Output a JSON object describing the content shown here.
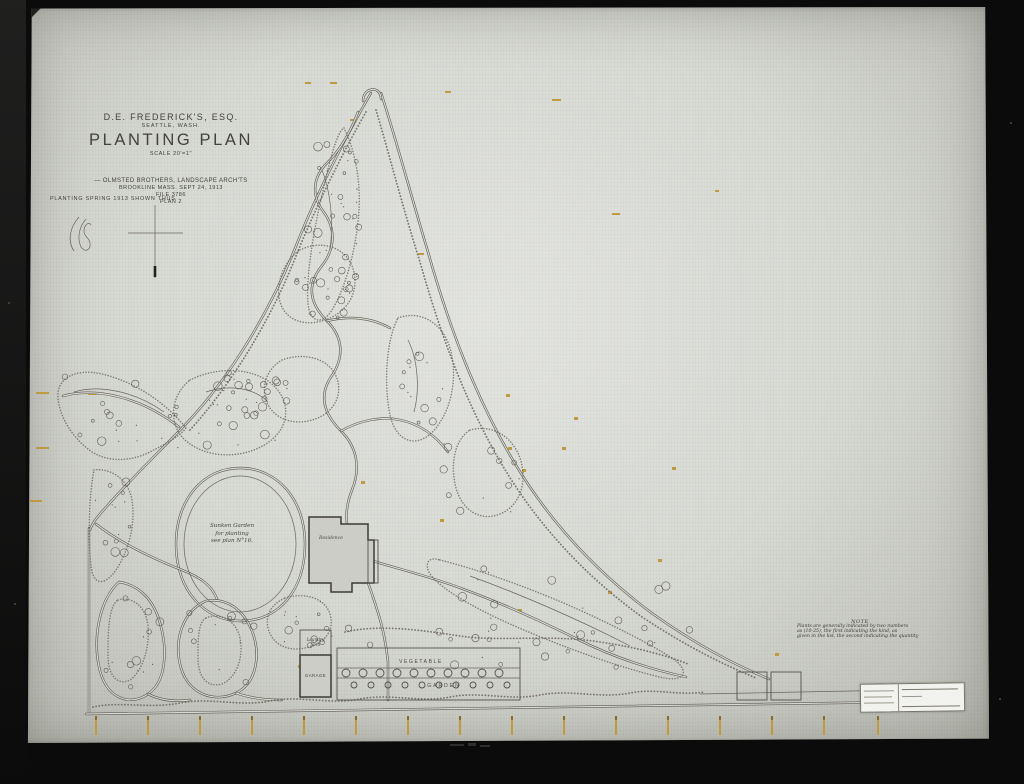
{
  "colors": {
    "paper": "#d7d9d3",
    "ink": "#45433d",
    "amber_marks": "#c09a3e",
    "mat_black": "#0b0b0b"
  },
  "title_block": {
    "client": "D.E. FREDERICK'S, ESQ.",
    "city": "SEATTLE, WASH.",
    "title": "PLANTING PLAN",
    "scale": "SCALE 20'=1\"",
    "firm": "— OLMSTED BROTHERS, LANDSCAPE ARCH'TS",
    "address_date": "BROOKLINE MASS.    SEPT 24, 1913",
    "file_no": "FILE 3786",
    "plan_no": "PLAN 2"
  },
  "legend": {
    "planting_note": "PLANTING SPRING 1913 SHOWN THUS"
  },
  "note": {
    "heading": "NOTE",
    "line1": "Plants are generally indicated by two numbers",
    "line2": "as (10-25), the first indicating the kind, as",
    "line3": "given in the list, the second indicating the quantity"
  },
  "labels": {
    "sunken_garden_1": "Sunken Garden",
    "sunken_garden_2": "for planting",
    "sunken_garden_3": "see plan N°16.",
    "residence": "Residence",
    "laundry_1": "Laundry",
    "laundry_2": "Yard",
    "garage": "GARAGE",
    "vegetable": "VEGETABLE",
    "garden": "GARDEN"
  }
}
